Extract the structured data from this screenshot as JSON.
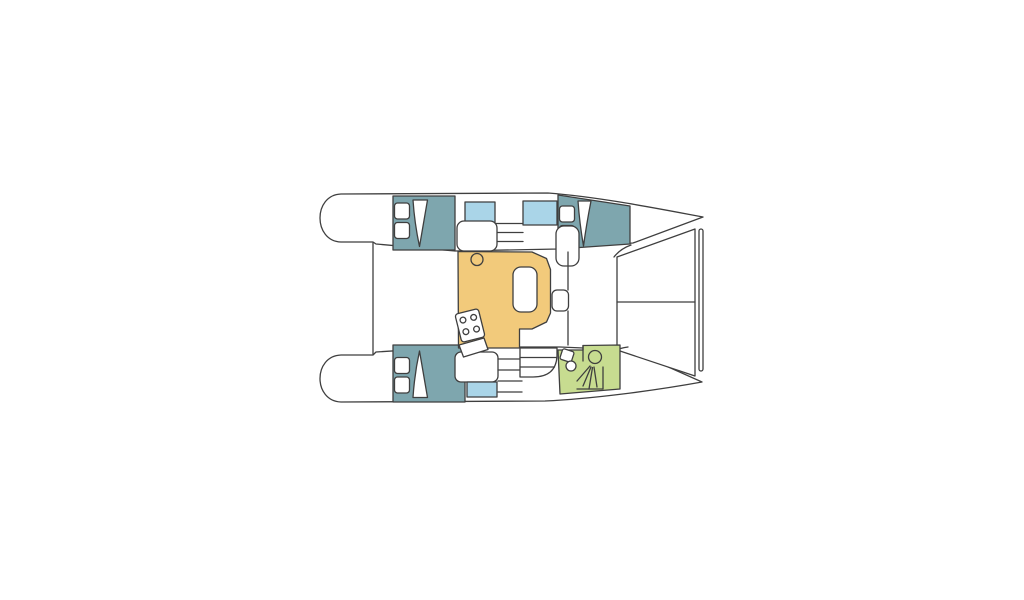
{
  "diagram": {
    "type": "catamaran-floor-plan",
    "canvas": {
      "width": 1024,
      "height": 600,
      "background": "#ffffff"
    },
    "palette": {
      "outline": "#3f3f3f",
      "hull_white": "#ffffff",
      "cabin_teal": "#7ea6ae",
      "window_blue": "#aad5e8",
      "saloon_yellow": "#f2ca7b",
      "bathroom_green": "#c7dc90"
    },
    "stroke_width": 1.3,
    "elements": [
      {
        "name": "hull-port",
        "kind": "path",
        "d": "M 376,244 L 455,251 L 558,249 L 633,243 L 703,217 C 660,209 600,197 548,193 L 341,194 C 313,195 313,241 341,242 L 373,242 Z",
        "fill": "#ffffff"
      },
      {
        "name": "hull-starboard",
        "kind": "path",
        "d": "M 376,352 L 455,347 L 560,347 L 630,350 L 702,382 C 652,391 590,399 545,401 L 341,402 C 313,401 313,356 341,355 L 373,355 Z",
        "fill": "#ffffff"
      },
      {
        "name": "aft-deck-edge",
        "kind": "line",
        "x1": 373,
        "y1": 243,
        "x2": 373,
        "y2": 354
      },
      {
        "name": "trampoline",
        "kind": "path",
        "d": "M 617,257 L 695,229 L 695,376 L 617,350 Z",
        "fill": "#ffffff"
      },
      {
        "name": "trampoline-divider",
        "kind": "line",
        "x1": 617,
        "y1": 302,
        "x2": 695,
        "y2": 302
      },
      {
        "name": "forward-crossbeam",
        "kind": "rect",
        "x": 699,
        "y": 229,
        "w": 4,
        "h": 142,
        "rx": 2,
        "fill": "#ffffff"
      },
      {
        "name": "deck-corner-port",
        "kind": "path",
        "d": "M 614,257 Q 620,249 631,245",
        "fill": "none"
      },
      {
        "name": "deck-corner-starboard",
        "kind": "path",
        "d": "M 614,351 Q 620,348 628,347",
        "fill": "none"
      },
      {
        "name": "cabin-aft-port",
        "kind": "rect",
        "x": 393,
        "y": 196,
        "w": 62,
        "h": 54,
        "fill": "#7ea6ae"
      },
      {
        "name": "berth-pillow",
        "kind": "rect",
        "x": 394.5,
        "y": 203,
        "w": 15,
        "h": 16,
        "rx": 3,
        "fill": "#ffffff"
      },
      {
        "name": "berth-pillow",
        "kind": "rect",
        "x": 394.5,
        "y": 222.5,
        "w": 15,
        "h": 16,
        "rx": 3,
        "fill": "#ffffff"
      },
      {
        "name": "door-sweep",
        "kind": "path",
        "d": "M 413,200 L 427.5,200 L 419.5,246.5 Q 414.5,223 413,200 Z",
        "fill": "#ffffff"
      },
      {
        "name": "hull-window-aft-port",
        "kind": "rect",
        "x": 465,
        "y": 202,
        "w": 30,
        "h": 21,
        "fill": "#aad5e8"
      },
      {
        "name": "companionway-step",
        "kind": "line",
        "x1": 496,
        "y1": 223.5,
        "x2": 523,
        "y2": 223.5
      },
      {
        "name": "companionway-step",
        "kind": "line",
        "x1": 496,
        "y1": 232.5,
        "x2": 523,
        "y2": 232.5
      },
      {
        "name": "companionway-step",
        "kind": "line",
        "x1": 496,
        "y1": 241.5,
        "x2": 523,
        "y2": 241.5
      },
      {
        "name": "hull-window-fwd-port",
        "kind": "rect",
        "x": 523,
        "y": 201,
        "w": 34,
        "h": 24,
        "fill": "#aad5e8"
      },
      {
        "name": "cabin-fwd-port",
        "kind": "path",
        "d": "M 558,195 L 630,206 L 630,244 L 558,249 Z",
        "fill": "#7ea6ae"
      },
      {
        "name": "berth-pillow",
        "kind": "rect",
        "x": 559.5,
        "y": 206,
        "w": 15,
        "h": 16,
        "rx": 3,
        "fill": "#ffffff"
      },
      {
        "name": "berth-pillow",
        "kind": "rect",
        "x": 559.5,
        "y": 225.5,
        "w": 15,
        "h": 16,
        "rx": 3,
        "fill": "#ffffff"
      },
      {
        "name": "door-sweep",
        "kind": "path",
        "d": "M 578,201 L 591,201 Q 586.5,224 583.5,246 Q 579.5,223 578,201 Z",
        "fill": "#ffffff"
      },
      {
        "name": "cabin-aft-starboard",
        "kind": "rect",
        "x": 393,
        "y": 345,
        "w": 72,
        "h": 57,
        "fill": "#7ea6ae"
      },
      {
        "name": "berth-pillow",
        "kind": "rect",
        "x": 394.5,
        "y": 357.5,
        "w": 15,
        "h": 16,
        "rx": 3,
        "fill": "#ffffff"
      },
      {
        "name": "berth-pillow",
        "kind": "rect",
        "x": 394.5,
        "y": 377,
        "w": 15,
        "h": 16,
        "rx": 3,
        "fill": "#ffffff"
      },
      {
        "name": "door-sweep",
        "kind": "path",
        "d": "M 413,397.5 L 427.5,397.5 L 419.5,351 Q 414.5,374 413,397.5 Z",
        "fill": "#ffffff"
      },
      {
        "name": "berth-aft-starboard",
        "kind": "rect",
        "x": 455,
        "y": 352,
        "w": 43,
        "h": 30,
        "rx": 6,
        "fill": "#ffffff"
      },
      {
        "name": "hull-window-aft-starboard",
        "kind": "rect",
        "x": 467,
        "y": 382,
        "w": 30,
        "h": 15,
        "fill": "#aad5e8"
      },
      {
        "name": "companionway-step",
        "kind": "line",
        "x1": 498,
        "y1": 359,
        "x2": 522,
        "y2": 359
      },
      {
        "name": "companionway-step",
        "kind": "line",
        "x1": 498,
        "y1": 370,
        "x2": 522,
        "y2": 370
      },
      {
        "name": "companionway-step",
        "kind": "line",
        "x1": 498,
        "y1": 381,
        "x2": 522,
        "y2": 381
      },
      {
        "name": "companionway-step",
        "kind": "line",
        "x1": 498,
        "y1": 392,
        "x2": 522,
        "y2": 392
      },
      {
        "name": "saloon-galley-floor",
        "kind": "path",
        "d": "M 458,251.5 L 532,252 L 546.5,258.5 L 550.5,269.5 L 550.5,313 L 546.5,322 L 532,329 L 519.5,329 L 519.5,348 L 458.5,348 Z",
        "fill": "#f2ca7b"
      },
      {
        "name": "sink-hatch",
        "kind": "circle",
        "cx": 477,
        "cy": 259.5,
        "r": 6,
        "fill": "none"
      },
      {
        "name": "dinette-table",
        "kind": "rect",
        "x": 513,
        "y": 267,
        "w": 24,
        "h": 45,
        "rx": 8,
        "fill": "#ffffff"
      },
      {
        "name": "stove-top",
        "kind": "rect",
        "x": 458,
        "y": 311,
        "w": 24,
        "h": 29,
        "rx": 3,
        "fill": "#ffffff",
        "transform": "rotate(-14 470 325.5)"
      },
      {
        "name": "stove-burner",
        "kind": "circle",
        "cx": 464.5,
        "cy": 318.5,
        "r": 2.9,
        "fill": "#ffffff",
        "transform": "rotate(-14 470 325.5)"
      },
      {
        "name": "stove-burner",
        "kind": "circle",
        "cx": 475.5,
        "cy": 318.5,
        "r": 2.9,
        "fill": "#ffffff",
        "transform": "rotate(-14 470 325.5)"
      },
      {
        "name": "stove-burner",
        "kind": "circle",
        "cx": 464.5,
        "cy": 330.5,
        "r": 2.9,
        "fill": "#ffffff",
        "transform": "rotate(-14 470 325.5)"
      },
      {
        "name": "stove-burner",
        "kind": "circle",
        "cx": 475.5,
        "cy": 330.5,
        "r": 2.9,
        "fill": "#ffffff",
        "transform": "rotate(-14 470 325.5)"
      },
      {
        "name": "galley-sink-board",
        "kind": "path",
        "d": "M 459,345 L 484,338 L 488,349.5 L 463.5,357 Z",
        "fill": "#ffffff"
      },
      {
        "name": "seat-aft-saloon",
        "kind": "rect",
        "x": 457,
        "y": 221,
        "w": 40,
        "h": 30,
        "rx": 7,
        "fill": "#ffffff"
      },
      {
        "name": "seat-fwd-saloon",
        "kind": "rect",
        "x": 556,
        "y": 226,
        "w": 23,
        "h": 40,
        "rx": 8,
        "fill": "#ffffff"
      },
      {
        "name": "partition-fwd-starboard",
        "kind": "path",
        "d": "M 520,348 L 557,348 L 557,356 Q 556,377 533,377 L 520,377 Z",
        "fill": "#ffffff"
      },
      {
        "name": "step-line",
        "kind": "line",
        "x1": 520,
        "y1": 357.5,
        "x2": 556.5,
        "y2": 357.5
      },
      {
        "name": "step-line",
        "kind": "line",
        "x1": 520,
        "y1": 367,
        "x2": 554.5,
        "y2": 367
      },
      {
        "name": "bathroom-floor",
        "kind": "path",
        "d": "M 558,350 L 583,350 L 583,345.5 L 620,345 L 620,389 L 560,394 Z",
        "fill": "#c7dc90"
      },
      {
        "name": "bathroom-partition",
        "kind": "line",
        "x1": 583,
        "y1": 345.5,
        "x2": 583,
        "y2": 361
      },
      {
        "name": "shower-stall",
        "kind": "polyline",
        "points": "577,389 603,389 603,367",
        "fill": "none"
      },
      {
        "name": "toilet-tank-icon",
        "kind": "rect",
        "x": 561,
        "y": 350,
        "w": 12,
        "h": 11,
        "rx": 2,
        "fill": "#ffffff",
        "transform": "rotate(18 567 355.5)"
      },
      {
        "name": "toilet-bowl-icon",
        "kind": "circle",
        "cx": 571,
        "cy": 366,
        "r": 5,
        "fill": "#ffffff"
      },
      {
        "name": "shower-head-icon",
        "kind": "circle",
        "cx": 595,
        "cy": 357,
        "r": 6.5,
        "fill": "none"
      },
      {
        "name": "shower-spray-icon",
        "kind": "line",
        "x1": 590,
        "y1": 366,
        "x2": 577,
        "y2": 381
      },
      {
        "name": "shower-spray-icon",
        "kind": "line",
        "x1": 591,
        "y1": 367,
        "x2": 583,
        "y2": 386
      },
      {
        "name": "shower-spray-icon",
        "kind": "line",
        "x1": 592.5,
        "y1": 367.5,
        "x2": 589,
        "y2": 389
      },
      {
        "name": "shower-spray-icon",
        "kind": "line",
        "x1": 594,
        "y1": 367,
        "x2": 597,
        "y2": 387
      },
      {
        "name": "walkway-edge",
        "kind": "line",
        "x1": 568,
        "y1": 252,
        "x2": 568,
        "y2": 290
      },
      {
        "name": "walkway-edge",
        "kind": "line",
        "x1": 568,
        "y1": 311,
        "x2": 568,
        "y2": 345
      },
      {
        "name": "mast-step",
        "kind": "rect",
        "x": 552,
        "y": 290,
        "w": 16.5,
        "h": 21,
        "rx": 5,
        "fill": "#ffffff"
      }
    ]
  }
}
